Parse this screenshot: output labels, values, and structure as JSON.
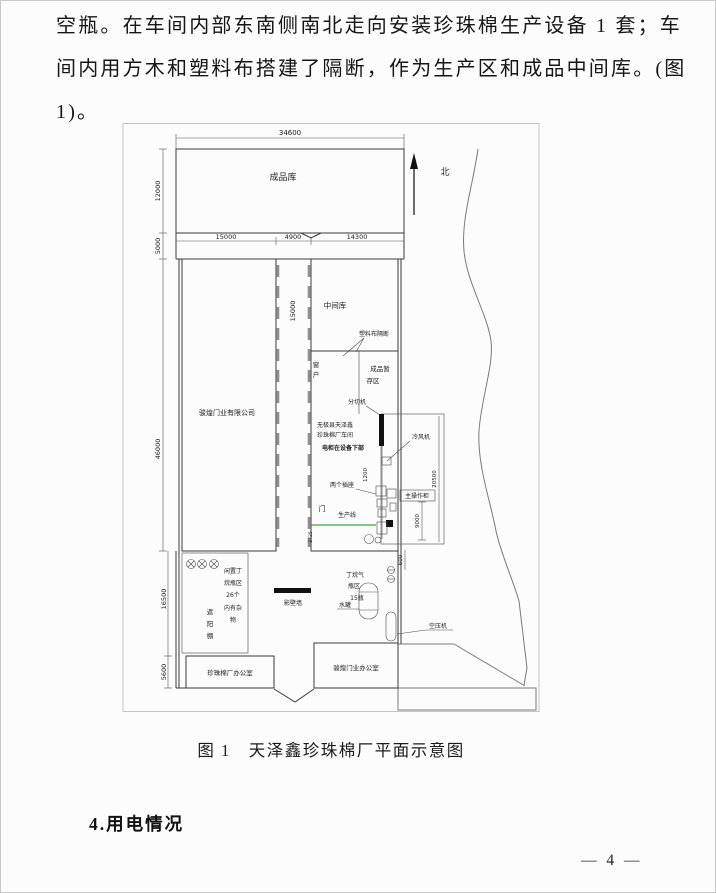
{
  "page": {
    "paragraph_lines": [
      "空瓶。在车间内部东南侧南北走向安装珍珠棉生产设备 1 套；车",
      "间内用方木和塑料布搭建了隔断，作为生产区和成品中间库。(图",
      "1)。"
    ],
    "caption_prefix": "图 1",
    "caption_text": "天泽鑫珍珠棉厂平面示意图",
    "section_heading": "4.用电情况",
    "page_number": "— 4 —"
  },
  "figure": {
    "north_label": "北",
    "dims": {
      "d34600": "34600",
      "d12000": "12000",
      "d5000": "5000",
      "d15000a": "15000",
      "d4900": "4900",
      "d14300": "14300",
      "d15000b": "15000",
      "d46000": "46000",
      "d16500": "16500",
      "d5600": "5600",
      "d1200": "1200",
      "d3725": "3725",
      "d20500": "20500",
      "d9000": "9000",
      "d600": "600"
    },
    "labels": {
      "finished_store": "成品库",
      "door_company": "骏煌门业有限公司",
      "mid_store": "中间库",
      "plastic_partition": "塑料布隔断",
      "window": [
        "窗",
        "户"
      ],
      "temp_store": [
        "成品暂",
        "存区"
      ],
      "slitter": "分切机",
      "workshop": [
        "无极县天泽鑫",
        "珍珠棉厂车间",
        "电柜在设备下部"
      ],
      "cooler": "冷风机",
      "two_sockets": "两个插座",
      "main_cabinet": "主操作柜",
      "door": "门",
      "production_line": "生产线",
      "idle_bottle_area": [
        "闲置丁",
        "烷瓶区",
        "26个",
        "内有杂",
        "物"
      ],
      "green_shed": [
        "遮",
        "阳",
        "棚"
      ],
      "screen_wall": "影壁墙",
      "butane_area": [
        "丁烷气",
        "瓶区",
        "15瓶"
      ],
      "water_tank": "水罐",
      "air_compressor": "空压机",
      "pearl_office": "珍珠棉厂办公室",
      "door_office": "骏煌门业办公室"
    },
    "colors": {
      "green_accent": "#3aa546"
    }
  }
}
